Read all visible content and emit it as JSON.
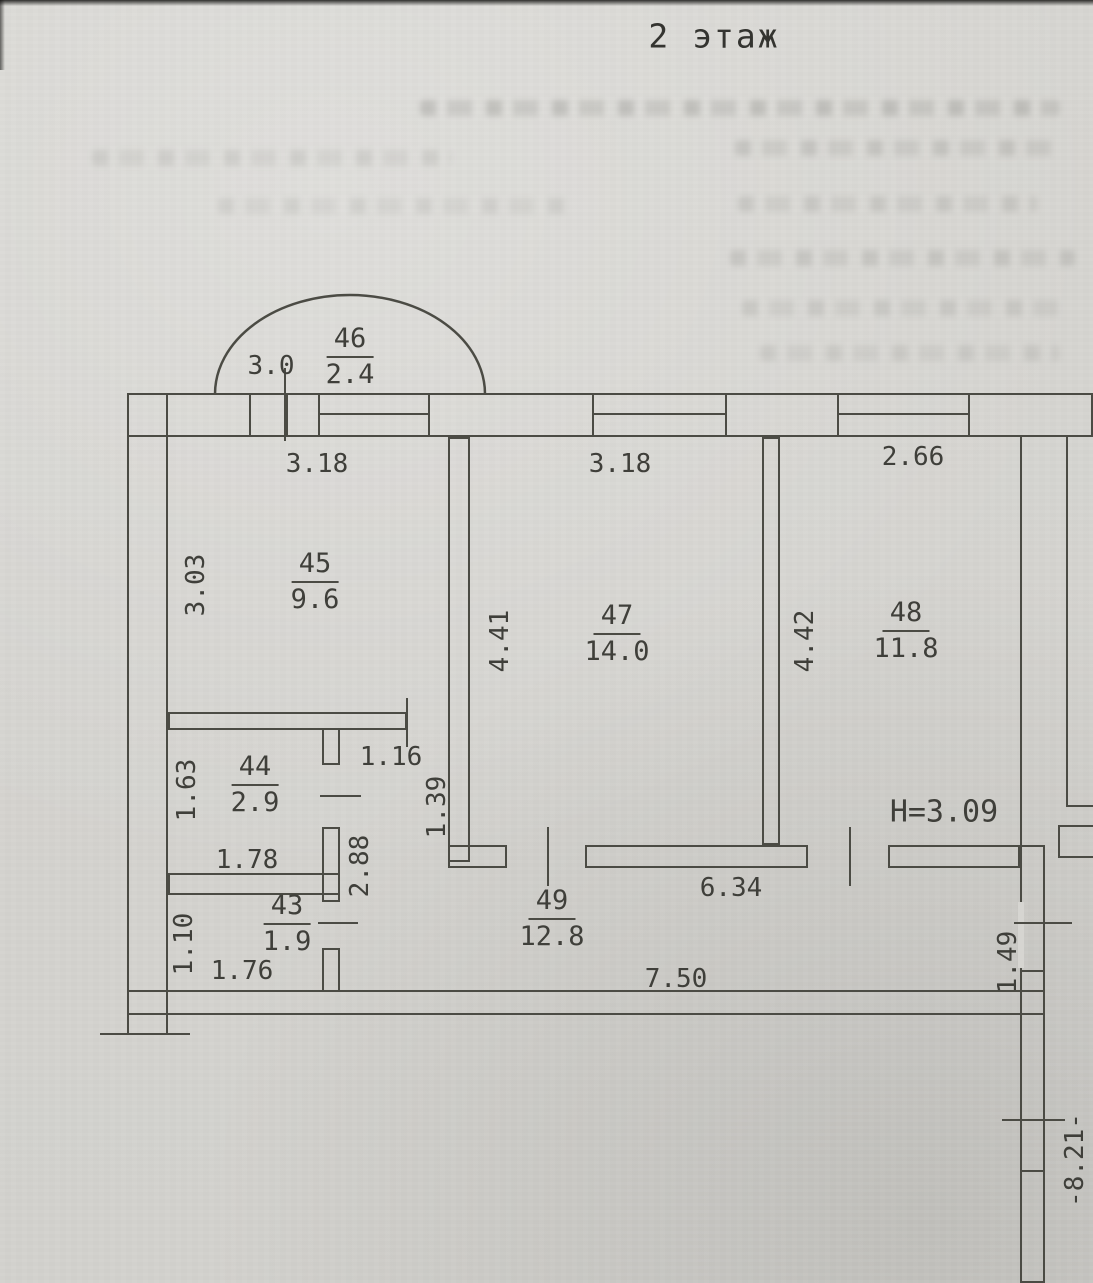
{
  "title": "2 этаж",
  "ceiling_height_label": "H=3.09",
  "rooms": {
    "r46": {
      "number": "46",
      "area": "2.4"
    },
    "r45": {
      "number": "45",
      "area": "9.6"
    },
    "r47": {
      "number": "47",
      "area": "14.0"
    },
    "r48": {
      "number": "48",
      "area": "11.8"
    },
    "r44": {
      "number": "44",
      "area": "2.9"
    },
    "r43": {
      "number": "43",
      "area": "1.9"
    },
    "r49": {
      "number": "49",
      "area": "12.8"
    }
  },
  "dims": {
    "balcony_width": "3.0",
    "room45_width": "3.18",
    "room45_depth": "3.03",
    "room47_width": "3.18",
    "room47_depth": "4.41",
    "room48_width": "2.66",
    "room48_depth": "4.42",
    "room44_width": "1.78",
    "room44_depth": "1.63",
    "room43_width": "1.76",
    "room43_depth": "1.10",
    "hall_width": "1.16",
    "hall_wall": "1.39",
    "hall_length": "2.88",
    "corridor_length": "6.34",
    "south_wall_length": "7.50",
    "right_opening": "1.49",
    "right_wall_run": "-8.21-"
  }
}
